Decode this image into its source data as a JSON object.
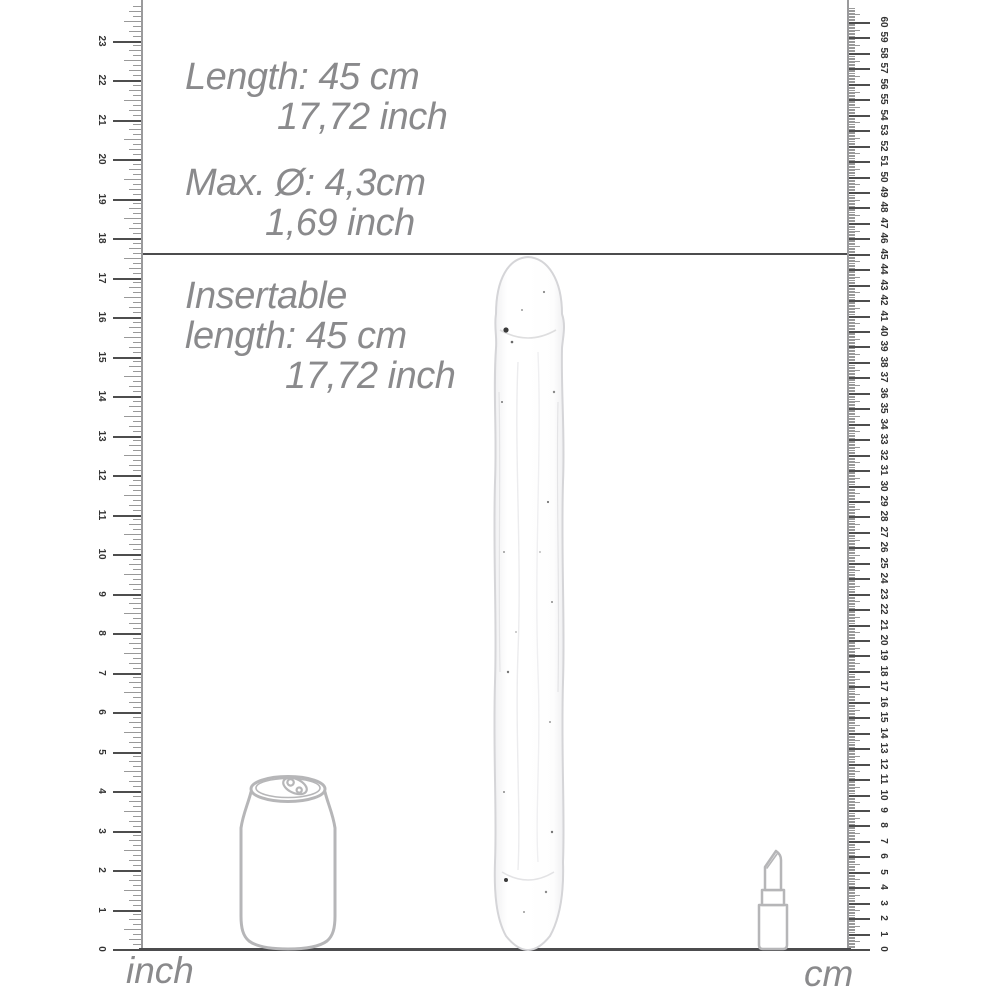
{
  "specs": {
    "length": {
      "line1": "Length: 45 cm",
      "line2": "17,72 inch"
    },
    "diameter": {
      "line1": "Max. Ø: 4,3cm",
      "line2": "1,69 inch"
    },
    "insertable": {
      "line1": "Insertable",
      "line2": "length: 45 cm",
      "line3": "17,72 inch"
    }
  },
  "rulers": {
    "inch": {
      "unit_label": "inch",
      "min": 0,
      "max": 23,
      "subdivisions": 8,
      "side": "left",
      "labels": [
        "0",
        "1",
        "2",
        "3",
        "4",
        "5",
        "6",
        "7",
        "8",
        "9",
        "10",
        "11",
        "12",
        "13",
        "14",
        "15",
        "16",
        "17",
        "18",
        "19",
        "20",
        "21",
        "22",
        "23"
      ]
    },
    "cm": {
      "unit_label": "cm",
      "min": 0,
      "max": 60,
      "subdivisions": 10,
      "side": "right",
      "labels": [
        "0",
        "1",
        "2",
        "3",
        "4",
        "5",
        "6",
        "7",
        "8",
        "9",
        "10",
        "11",
        "12",
        "13",
        "14",
        "15",
        "16",
        "17",
        "18",
        "19",
        "20",
        "21",
        "22",
        "23",
        "24",
        "25",
        "26",
        "27",
        "28",
        "29",
        "30",
        "31",
        "32",
        "33",
        "34",
        "35",
        "36",
        "37",
        "38",
        "39",
        "40",
        "41",
        "42",
        "43",
        "44",
        "45",
        "46",
        "47",
        "48",
        "49",
        "50",
        "51",
        "52",
        "53",
        "54",
        "55",
        "56",
        "57",
        "58",
        "59",
        "60"
      ]
    }
  },
  "illustrations": {
    "product": "clear-double-ended-dildo",
    "can": "soda-can-outline",
    "lipstick": "lipstick-outline"
  },
  "colors": {
    "spec_text": "#8a8a8c",
    "ruler_number": "#333333",
    "tick_minor": "#999999",
    "tick_major": "#4d4d4d",
    "measure_line": "#4c4c4e",
    "outline_gray": "#b6b6b8",
    "product_stroke": "#d5d5d8"
  }
}
